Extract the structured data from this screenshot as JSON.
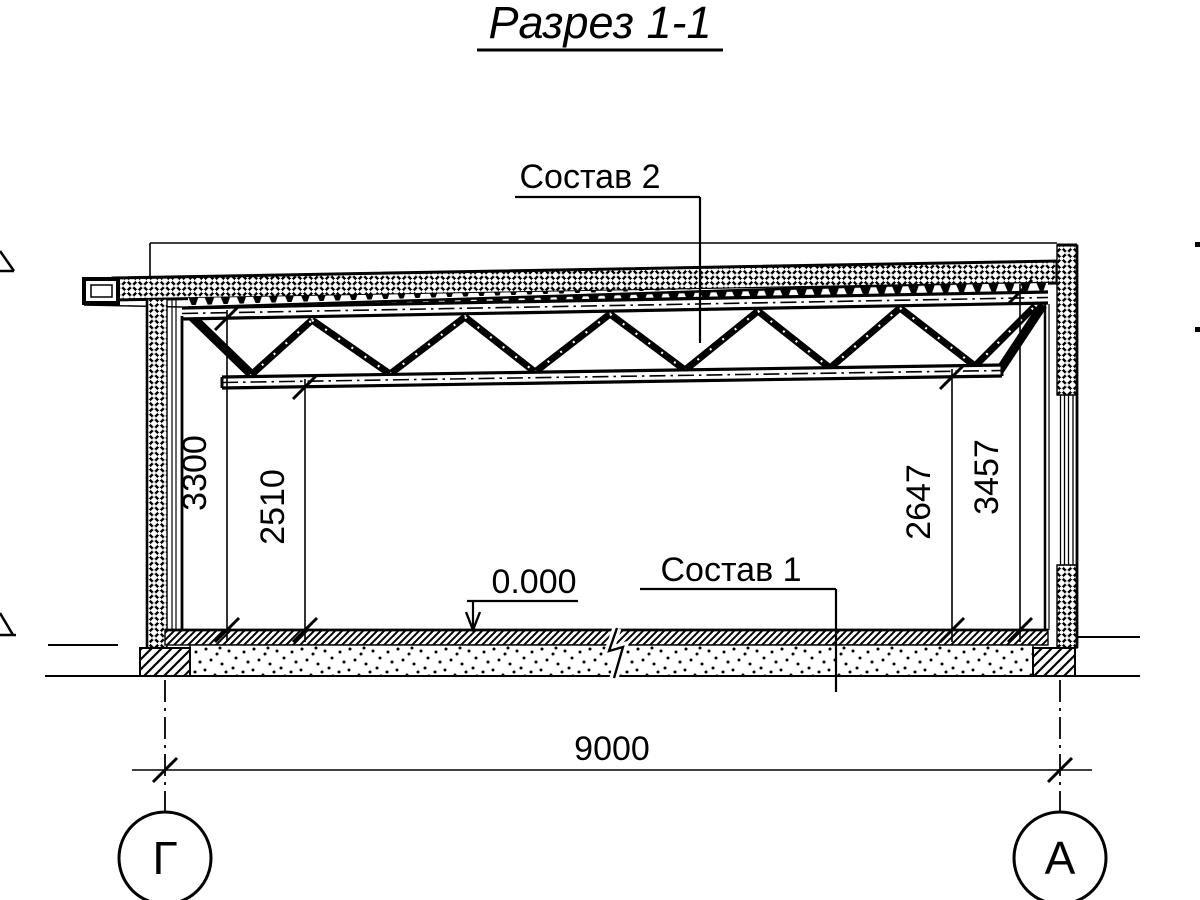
{
  "title": "Разрез 1-1",
  "callouts": {
    "roof_assembly": "Состав 2",
    "floor_assembly": "Состав 1",
    "zero_elevation": "0.000"
  },
  "dimensions": {
    "height_left_wall": "3300",
    "height_left_truss_bottom": "2510",
    "height_right_truss_bottom": "2647",
    "height_right_wall": "3457",
    "span": "9000"
  },
  "axes": {
    "left_label": "Г",
    "right_label": "А"
  },
  "colors": {
    "ink": "#000000",
    "paper": "#ffffff"
  }
}
